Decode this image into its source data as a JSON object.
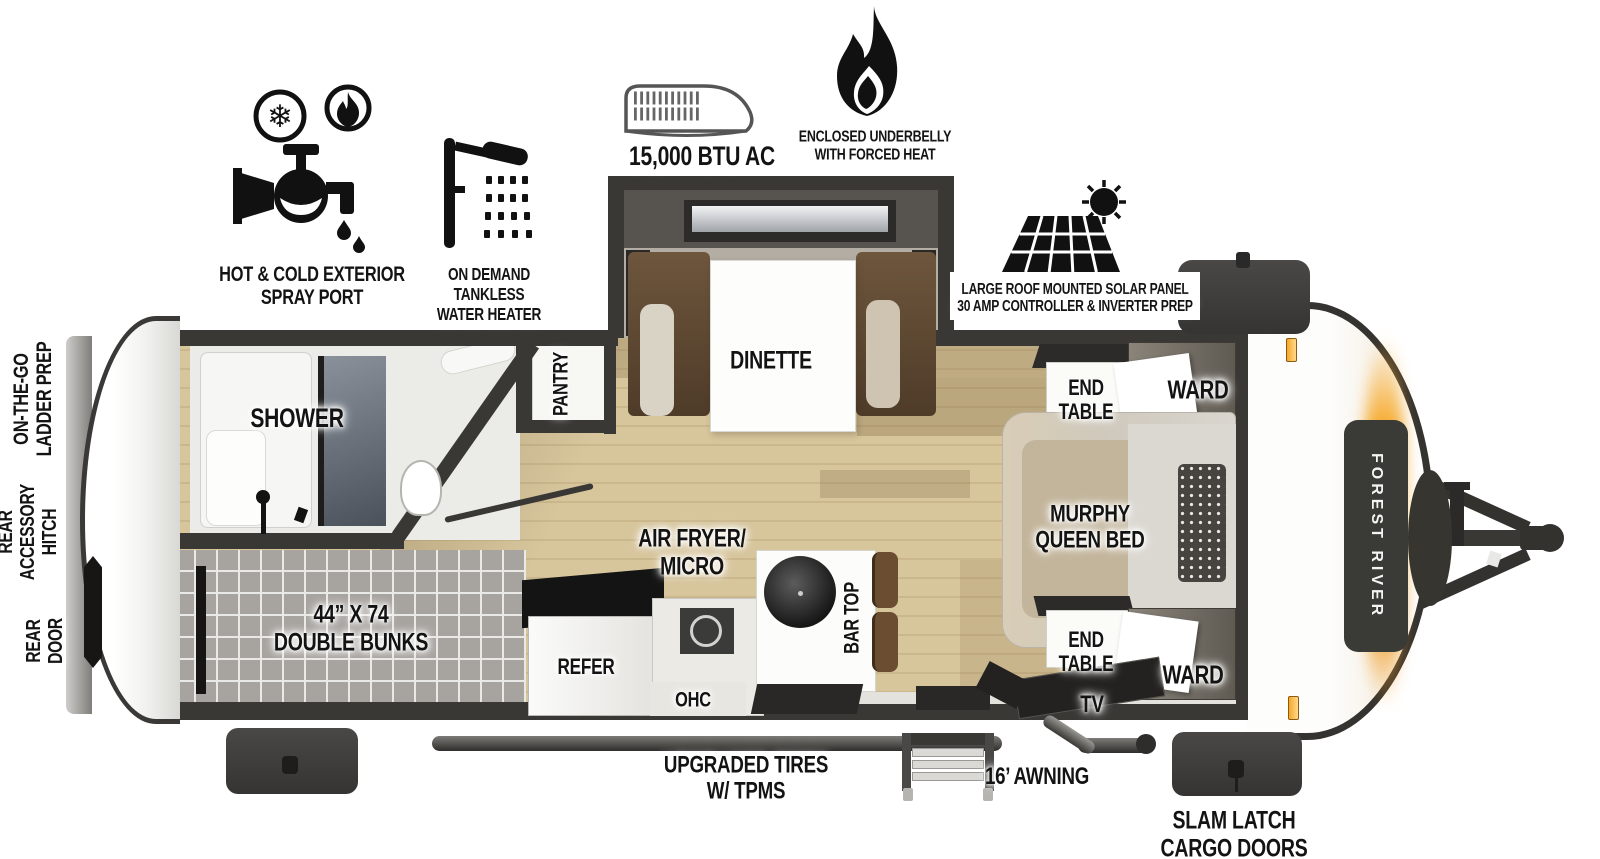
{
  "title": "Forest River travel trailer floorplan",
  "brand": "FOREST RIVER",
  "features": {
    "spray_port": "HOT & COLD EXTERIOR\nSPRAY PORT",
    "water_heater": "ON DEMAND\nTANKLESS\nWATER HEATER",
    "ac": "15,000 BTU AC",
    "underbelly": "ENCLOSED UNDERBELLY\nWITH FORCED HEAT",
    "solar": "LARGE ROOF MOUNTED SOLAR PANEL\n30 AMP CONTROLLER & INVERTER PREP"
  },
  "exterior": {
    "ladder_prep": "ON-THE-GO\nLADDER PREP",
    "rear_hitch": "REAR\nACCESSORY\nHITCH",
    "rear_door": "REAR\nDOOR",
    "tires": "UPGRADED TIRES\nW/ TPMS",
    "awning": "16’ AWNING",
    "cargo_doors": "SLAM LATCH\nCARGO DOORS"
  },
  "rooms": {
    "shower": "SHOWER",
    "pantry": "PANTRY",
    "dinette": "DINETTE",
    "bunks": "44” X 74\nDOUBLE BUNKS",
    "refer": "REFER",
    "air_fryer": "AIR FRYER/\nMICRO",
    "ohc": "OHC",
    "bar_top": "BAR TOP",
    "end_table_top": "END\nTABLE",
    "ward_top": "WARD",
    "murphy_bed": "MURPHY\nQUEEN BED",
    "end_table_bottom": "END\nTABLE",
    "ward_bottom": "WARD",
    "tv": "TV"
  },
  "icons": {
    "spray_port": "faucet-hot-cold-icon",
    "water_heater": "shower-head-icon",
    "ac": "rooftop-ac-icon",
    "underbelly": "flame-icon",
    "solar": "solar-panel-sun-icon"
  },
  "colors": {
    "wall": "#3a3835",
    "floor_wood": "#d7c59c",
    "accent_orange": "#f6a829",
    "cargo_door": "#3f3e3c",
    "label_text": "#131313"
  }
}
